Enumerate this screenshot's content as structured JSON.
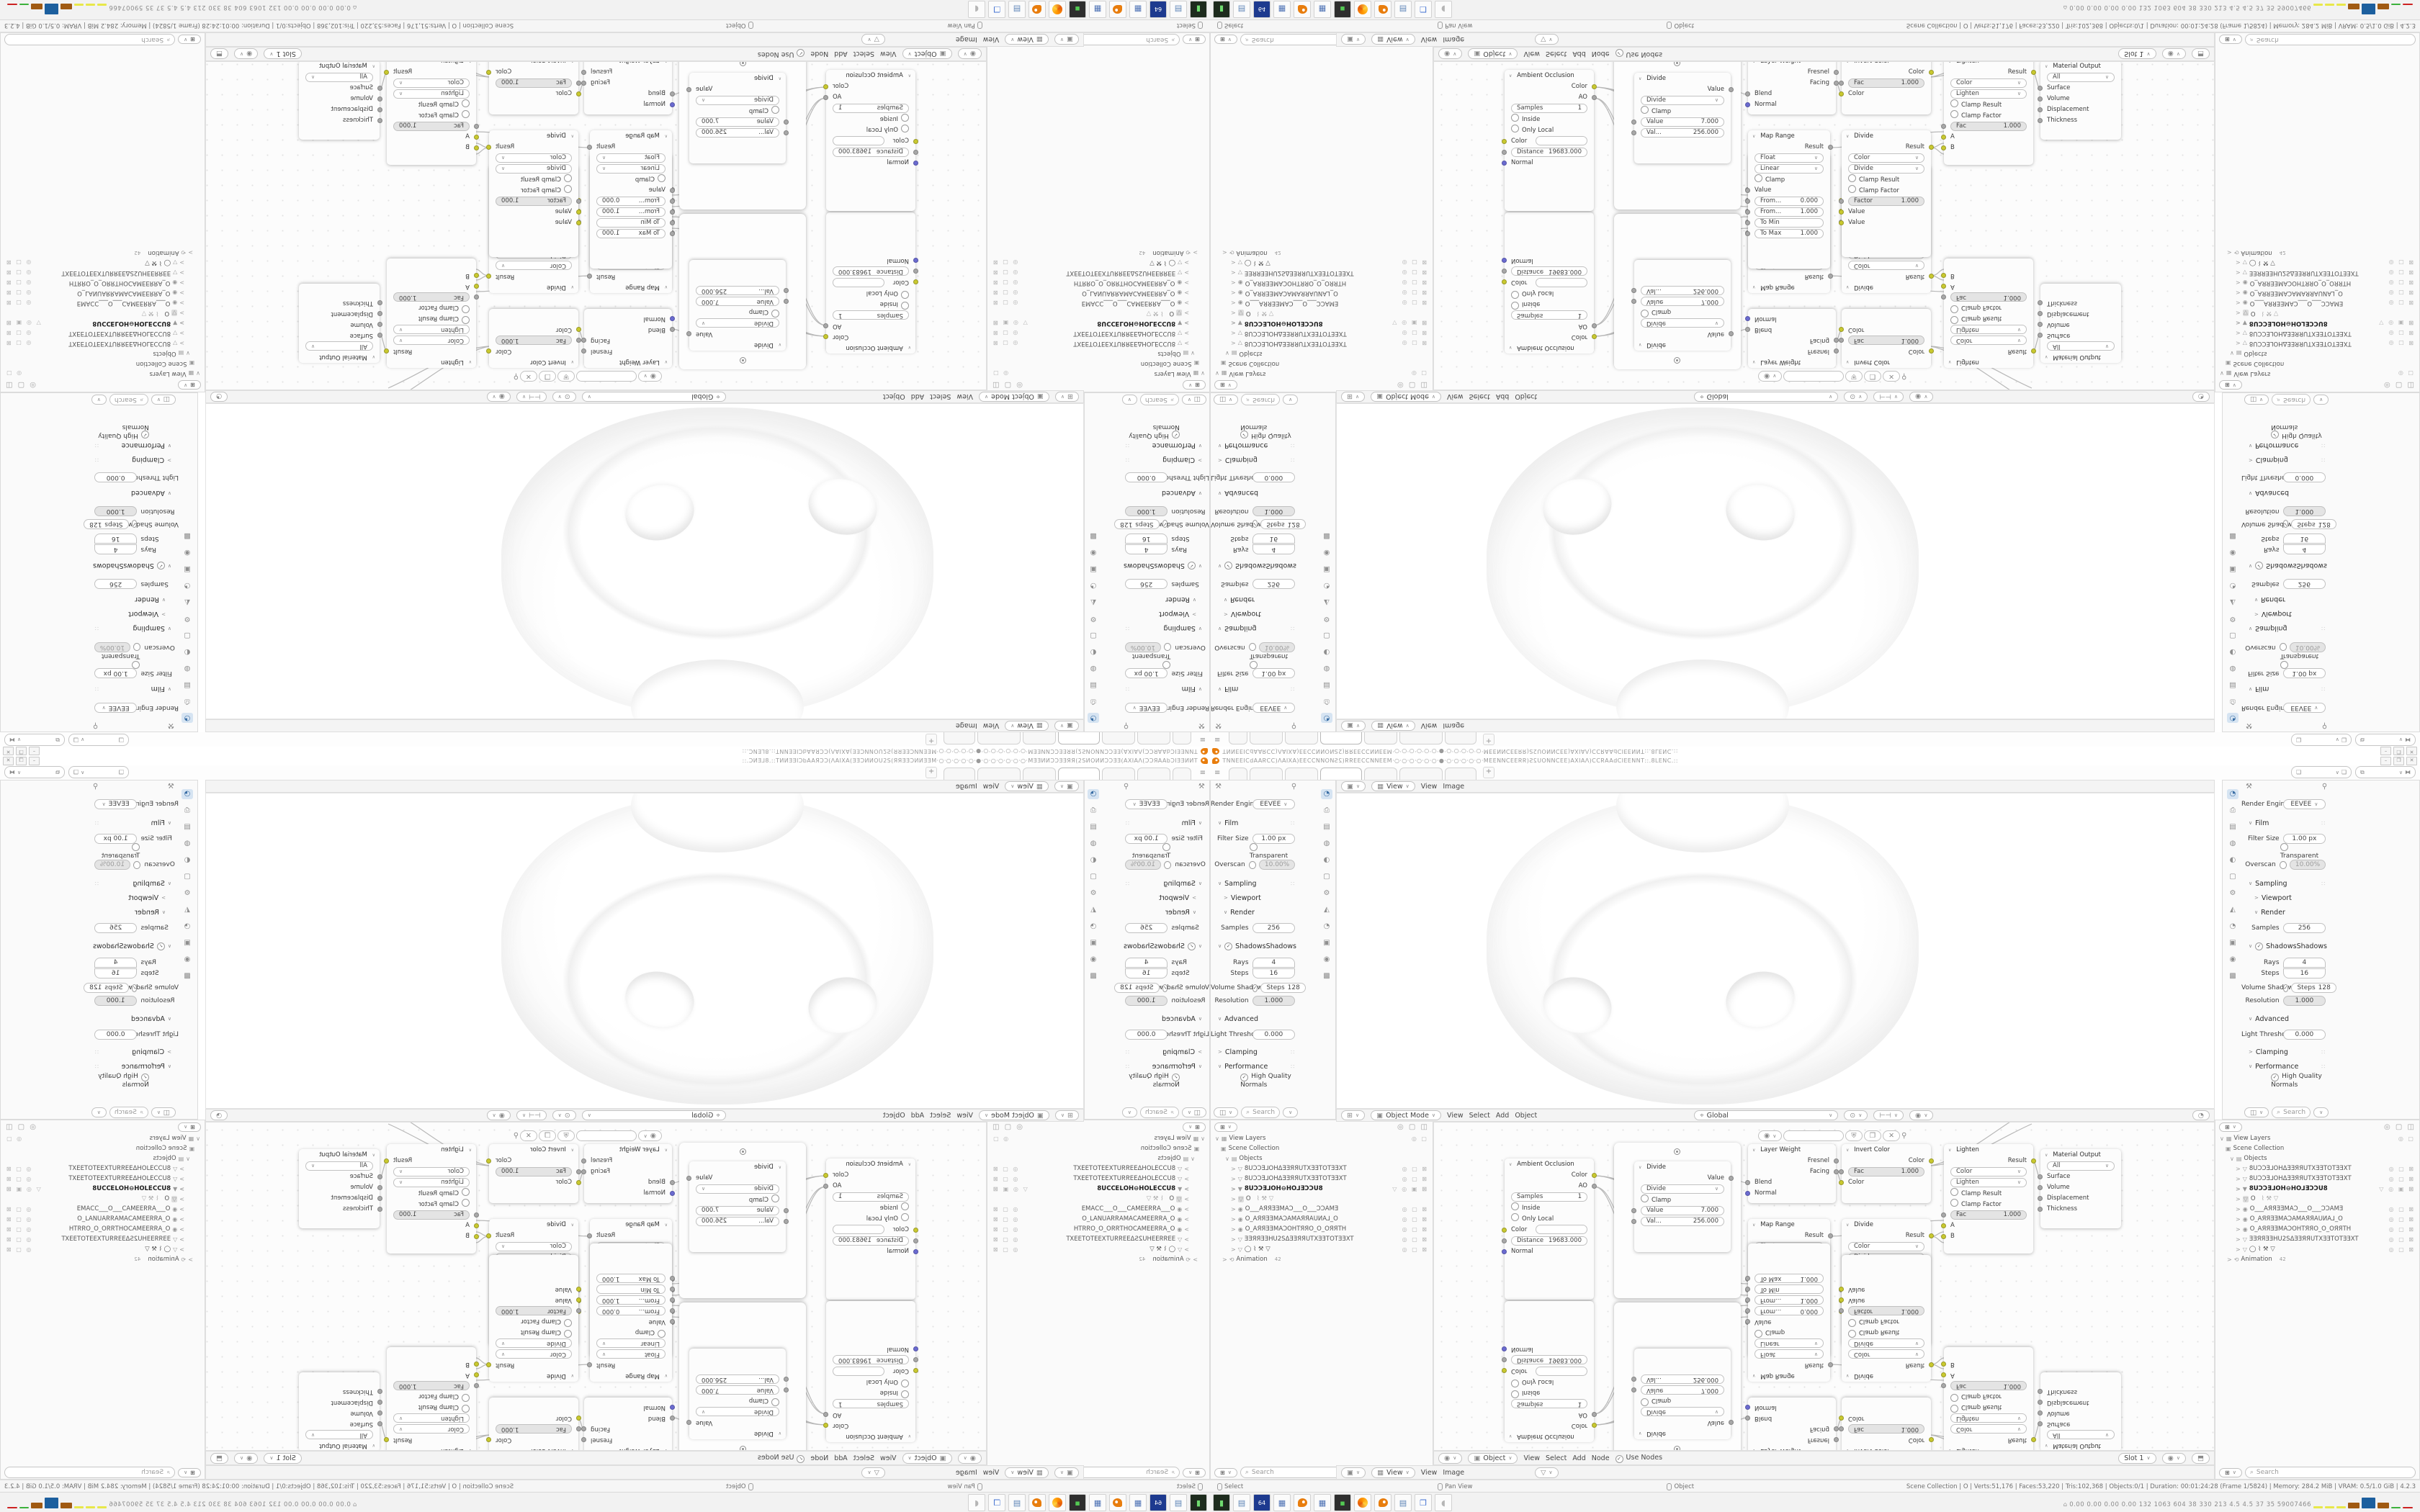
{
  "window": {
    "title": "ƆИƎ⅃8.::TИИƎƎIƆbAAЯƆƆ(ΛAIXA(ƎƎƆИИOU2S(ЯЯƎƎƆИИƎƎM·○·○·○·○·○·●·○·○·○·○·○·○·MƎƎИИƆƆƎƎЯЯ(2SИOИИƆƆƎƎ(AXIAΛ(ƆƆЯAAbƆIƎƎИИT.::",
    "min": "–",
    "restore": "❐",
    "close": "✕",
    "tabs_plus": "+",
    "hamburger": "≡"
  },
  "props": {
    "render_engine_label": "Render Engine",
    "render_engine_value": "EEVEE",
    "film_section": "Film",
    "filter_size_label": "Filter Size",
    "filter_size": "1.00 px",
    "transparent_label": "Transparent",
    "overscan_label": "Overscan",
    "overscan": "10.00%",
    "sampling_section": "Sampling",
    "viewport_sub": "Viewport",
    "render_sub": "Render",
    "samples_label": "Samples",
    "samples": "256",
    "shadows_section": "Shadows",
    "rays_label": "Rays",
    "rays": "4",
    "steps_label": "Steps",
    "steps": "16",
    "volume_label": "Volume Shadows",
    "volume_steps_label": "Steps",
    "volume_steps": "128",
    "resolution_label": "Resolution",
    "resolution": "1.000",
    "advanced_section": "Advanced",
    "light_threshold_label": "Light Threshold",
    "light_threshold": "0.000",
    "clamping_section": "Clamping",
    "performance_section": "Performance",
    "hq_normals": "High Quality Normals",
    "search_placeholder": "Search"
  },
  "outliner": {
    "view_layers": "View Layers",
    "scene_collection": "Scene Collection",
    "objects": "Objects",
    "items": [
      {
        "icon": "▽",
        "label": "8UƆƆƎ⅃OHΔƎƎЯЯUTXƎƎTOTƎƎXT"
      },
      {
        "icon": "▽",
        "label": "8UƆƆƎ⅃OHΔƎƎЯЯUTXƎƎTOTƎƎXT"
      },
      {
        "icon": "▼",
        "label": "8UƆƆƎ⅃OH⊖HO⅃ƎƆƆU8"
      },
      {
        "icon": "▽",
        "label": "O"
      },
      {
        "icon": "◉",
        "label": "O___AЯЯƎƎMAƆ___O___ƆƆAMƎ"
      },
      {
        "icon": "◉",
        "label": "O_AЯЯƎƎMAƆAMAЯЯAUИA⅃_O"
      },
      {
        "icon": "◉",
        "label": "O_AЯЯƎƎMAƆOHTЯЯO_O_OЯЯTH"
      },
      {
        "icon": "▽",
        "label": "ƎƎЯЯƎƎHU2SΔƎƎЯЯUTXƎƎTOTƎƎXT"
      },
      {
        "icon": "▽",
        "label": "◯  ⌇ ⚒  ▽"
      }
    ],
    "animation": "Animation",
    "animation_badge": "42",
    "search_placeholder": "Search"
  },
  "viewport": {
    "mode": "Object Mode",
    "menus": [
      "View",
      "Select",
      "Add",
      "Object"
    ],
    "orientation": "Global"
  },
  "image_editor": {
    "view_btn": "View",
    "menus": [
      "View",
      "Image"
    ]
  },
  "node_editor": {
    "object": "Object",
    "menus": [
      "View",
      "Select",
      "Add",
      "Node"
    ],
    "use_nodes": "Use Nodes",
    "slot": "Slot 1",
    "nodes": {
      "ao": {
        "title": "Ambient Occlusion",
        "out_color": "Color",
        "out_ao": "AO",
        "samples_label": "Samples",
        "samples": "1",
        "inside": "Inside",
        "only_local": "Only Local",
        "color_label": "Color",
        "distance_label": "Distance",
        "distance": "19683.000",
        "normal": "Normal"
      },
      "divide_a": {
        "title": "Divide",
        "out": "Value",
        "op": "Divide",
        "clamp": "Clamp",
        "in1_label": "Value",
        "in1": "7.000",
        "in2_label": "Val...",
        "in2": "256.000"
      },
      "layer_weight": {
        "title": "Layer Weight",
        "fresnel": "Fresnel",
        "facing": "Facing",
        "blend": "Blend",
        "normal": "Normal"
      },
      "invert": {
        "title": "Invert Color",
        "out": "Color",
        "fac_label": "Fac",
        "fac": "1.000",
        "in": "Color"
      },
      "map_range": {
        "title": "Map Range",
        "out": "Result",
        "type": "Float",
        "interp": "Linear",
        "clamp": "Clamp",
        "value": "Value",
        "from_min_label": "From...",
        "from_min": "0.000",
        "from_max_label": "From...",
        "from_max": "1.000",
        "to_min_label": "To Min",
        "to_max_label": "To Max",
        "to_max": "1.000"
      },
      "divide_c": {
        "title": "Divide",
        "out": "Result",
        "type": "Color",
        "op": "Divide",
        "clamp_result": "Clamp Result",
        "clamp_factor": "Clamp Factor",
        "factor_label": "Factor",
        "factor": "1.000",
        "value1": "Value",
        "value2": "Value"
      },
      "lighten": {
        "title": "Lighten",
        "out": "Result",
        "type": "Color",
        "op": "Lighten",
        "clamp_result": "Clamp Result",
        "clamp_factor": "Clamp Factor",
        "fac_label": "Fac",
        "fac": "1.000",
        "a": "A",
        "b": "B"
      },
      "output": {
        "title": "Material Output",
        "target": "All",
        "surface": "Surface",
        "volume": "Volume",
        "displacement": "Displacement",
        "thickness": "Thickness"
      }
    }
  },
  "status": {
    "hint_select": "Select",
    "hint_pan": "Pan View",
    "hint_object": "Object",
    "info": "Scene Collection | O | Verts:51,176 | Faces:53,220 | Tris:102,368 | Objects:0/1 | Duration: 00:01:24:28 (Frame 1/5824) | Memory: 284.2 MiB | VRAM: 0.5/1.0 GiB | 4.2.3"
  },
  "taskbar": {
    "monitor_numbers": "0.00 0.00 0.00 0.00  132  1063 604   38   330  213   4.5   4.5   37    35  59007466",
    "floppy_label": "64"
  }
}
